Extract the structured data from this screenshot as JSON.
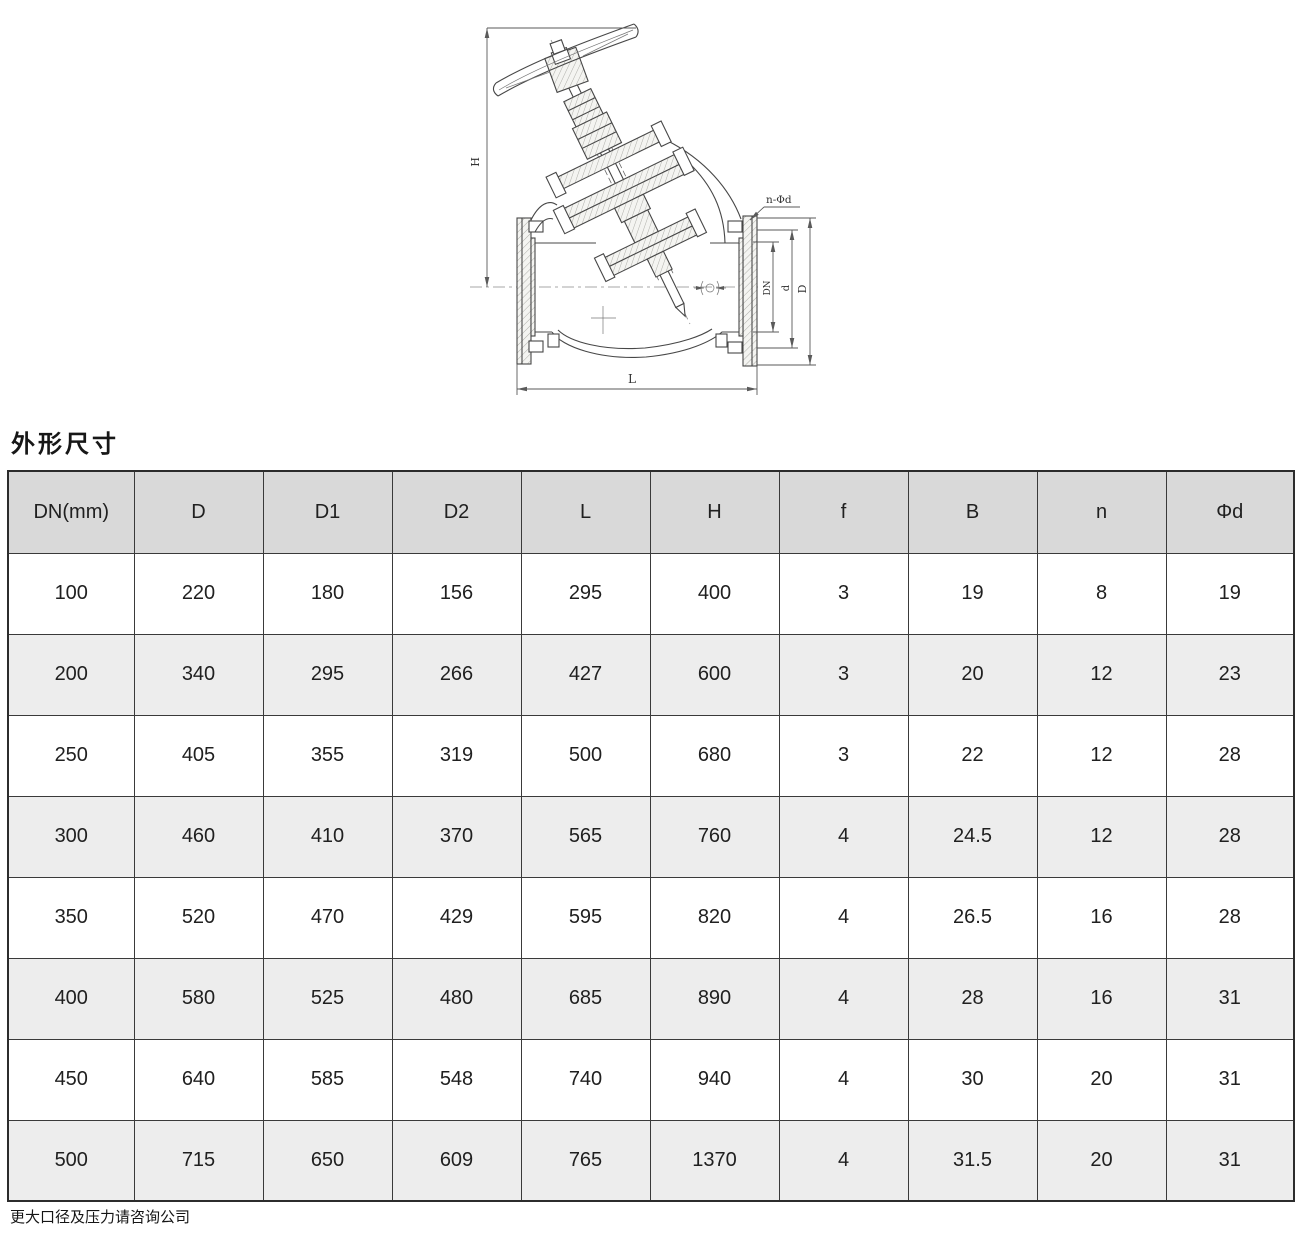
{
  "section": {
    "title": "外形尺寸"
  },
  "drawing": {
    "description": "Y-pattern flanged valve sectional outline drawing",
    "labels": {
      "h": "H",
      "l": "L",
      "dn": "DN",
      "d": "d",
      "big_d": "D",
      "n_phi_d": "n-Φd"
    }
  },
  "table": {
    "headers": [
      "DN(mm)",
      "D",
      "D1",
      "D2",
      "L",
      "H",
      "f",
      "B",
      "n",
      "Φd"
    ],
    "rows": [
      [
        "100",
        "220",
        "180",
        "156",
        "295",
        "400",
        "3",
        "19",
        "8",
        "19"
      ],
      [
        "200",
        "340",
        "295",
        "266",
        "427",
        "600",
        "3",
        "20",
        "12",
        "23"
      ],
      [
        "250",
        "405",
        "355",
        "319",
        "500",
        "680",
        "3",
        "22",
        "12",
        "28"
      ],
      [
        "300",
        "460",
        "410",
        "370",
        "565",
        "760",
        "4",
        "24.5",
        "12",
        "28"
      ],
      [
        "350",
        "520",
        "470",
        "429",
        "595",
        "820",
        "4",
        "26.5",
        "16",
        "28"
      ],
      [
        "400",
        "580",
        "525",
        "480",
        "685",
        "890",
        "4",
        "28",
        "16",
        "31"
      ],
      [
        "450",
        "640",
        "585",
        "548",
        "740",
        "940",
        "4",
        "30",
        "20",
        "31"
      ],
      [
        "500",
        "715",
        "650",
        "609",
        "765",
        "1370",
        "4",
        "31.5",
        "20",
        "31"
      ]
    ]
  },
  "footer": {
    "note": "更大口径及压力请咨询公司"
  },
  "colors": {
    "header_bg": "#d9d9d9",
    "alt_row_bg": "#ededed",
    "border": "#3a3a3a",
    "line": "#474747"
  }
}
